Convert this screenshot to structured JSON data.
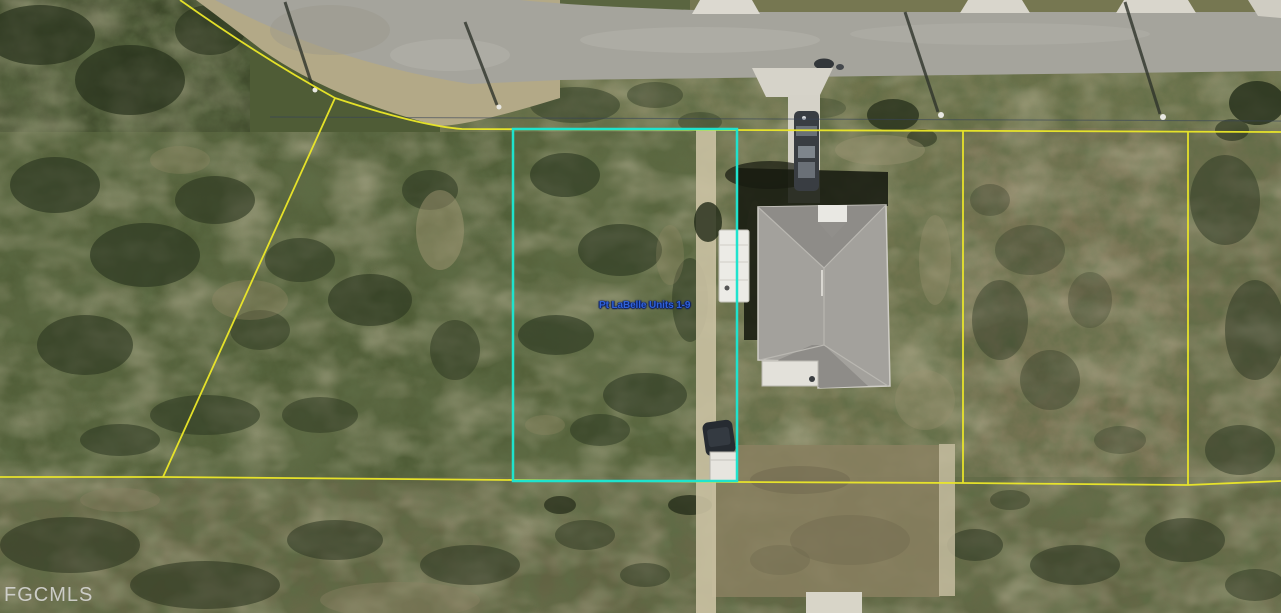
{
  "photo": {
    "parcel_label": "Pt LaBelle Units 1-9",
    "watermark": "FGCMLS",
    "colors": {
      "lot_line_yellow": "#ece829",
      "parcel_highlight_cyan": "#1fe3cd",
      "label_blue": "#2f62d8",
      "watermark_gray": "#e3e3e1"
    }
  }
}
